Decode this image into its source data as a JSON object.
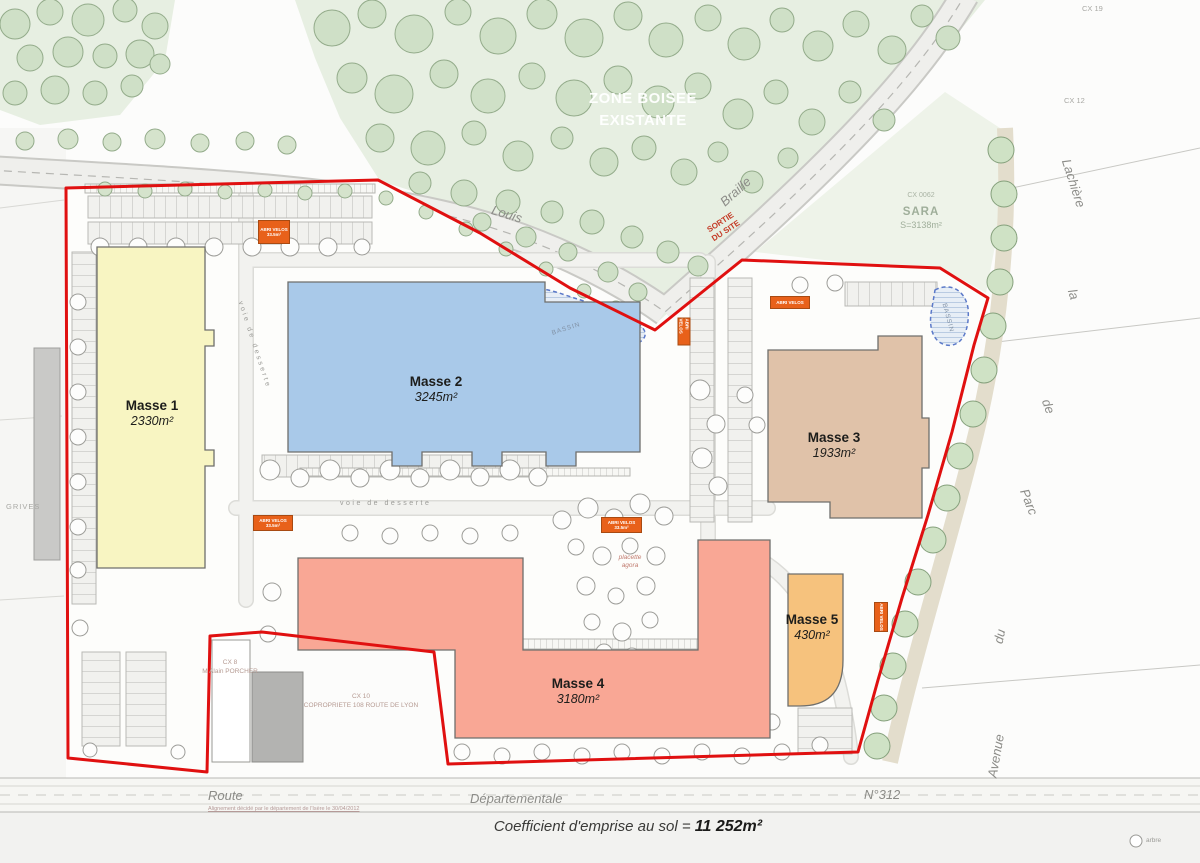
{
  "plan": {
    "zone_boisee_line1": "ZONE BOISEE",
    "zone_boisee_line2": "EXISTANTE",
    "masses": [
      {
        "name": "Masse 1",
        "area": "2330m²",
        "color": "#f8f5c2"
      },
      {
        "name": "Masse 2",
        "area": "3245m²",
        "color": "#a9c9e9"
      },
      {
        "name": "Masse 3",
        "area": "1933m²",
        "color": "#e0c2a9"
      },
      {
        "name": "Masse 4",
        "area": "3180m²",
        "color": "#f9a795"
      },
      {
        "name": "Masse 5",
        "area": "430m²",
        "color": "#f6c27d"
      }
    ],
    "coefficient_label": "Coefficient d'emprise au sol =",
    "coefficient_value": "11 252m²",
    "sortie_line1": "SORTIE",
    "sortie_line2": "DU SITE",
    "placette_line1": "placette",
    "placette_line2": "agora",
    "bassin": "BASSIN",
    "voie_de_desserte": "voie de desserte",
    "abri_label": "ABRI VELOS",
    "abri_area": "33.5m²",
    "boundary_color": "#e01010"
  },
  "streets": {
    "louis": "Louis",
    "braille": "Braille",
    "route": "Route",
    "departementale": "Départementale",
    "n312": "N°312",
    "avenue": [
      "Lachière",
      "la",
      "de",
      "Parc",
      "du",
      "Avenue"
    ]
  },
  "parcels": {
    "cx19": "CX 19",
    "cx12": "CX 12",
    "sara_ref": "CX 0062",
    "sara_name": "SARA",
    "sara_area": "S=3138m²",
    "cx8_ref": "CX 8",
    "cx8_owner": "M Alain PORCHER",
    "cx10_ref": "CX 10",
    "cx10_owner": "COPROPRIETE 108 ROUTE DE LYON",
    "grives": "GRIVES"
  },
  "notes": {
    "alignement": "Alignement décidé par le département de l'Isère le 30/04/2012",
    "legend_tree": "arbre"
  }
}
